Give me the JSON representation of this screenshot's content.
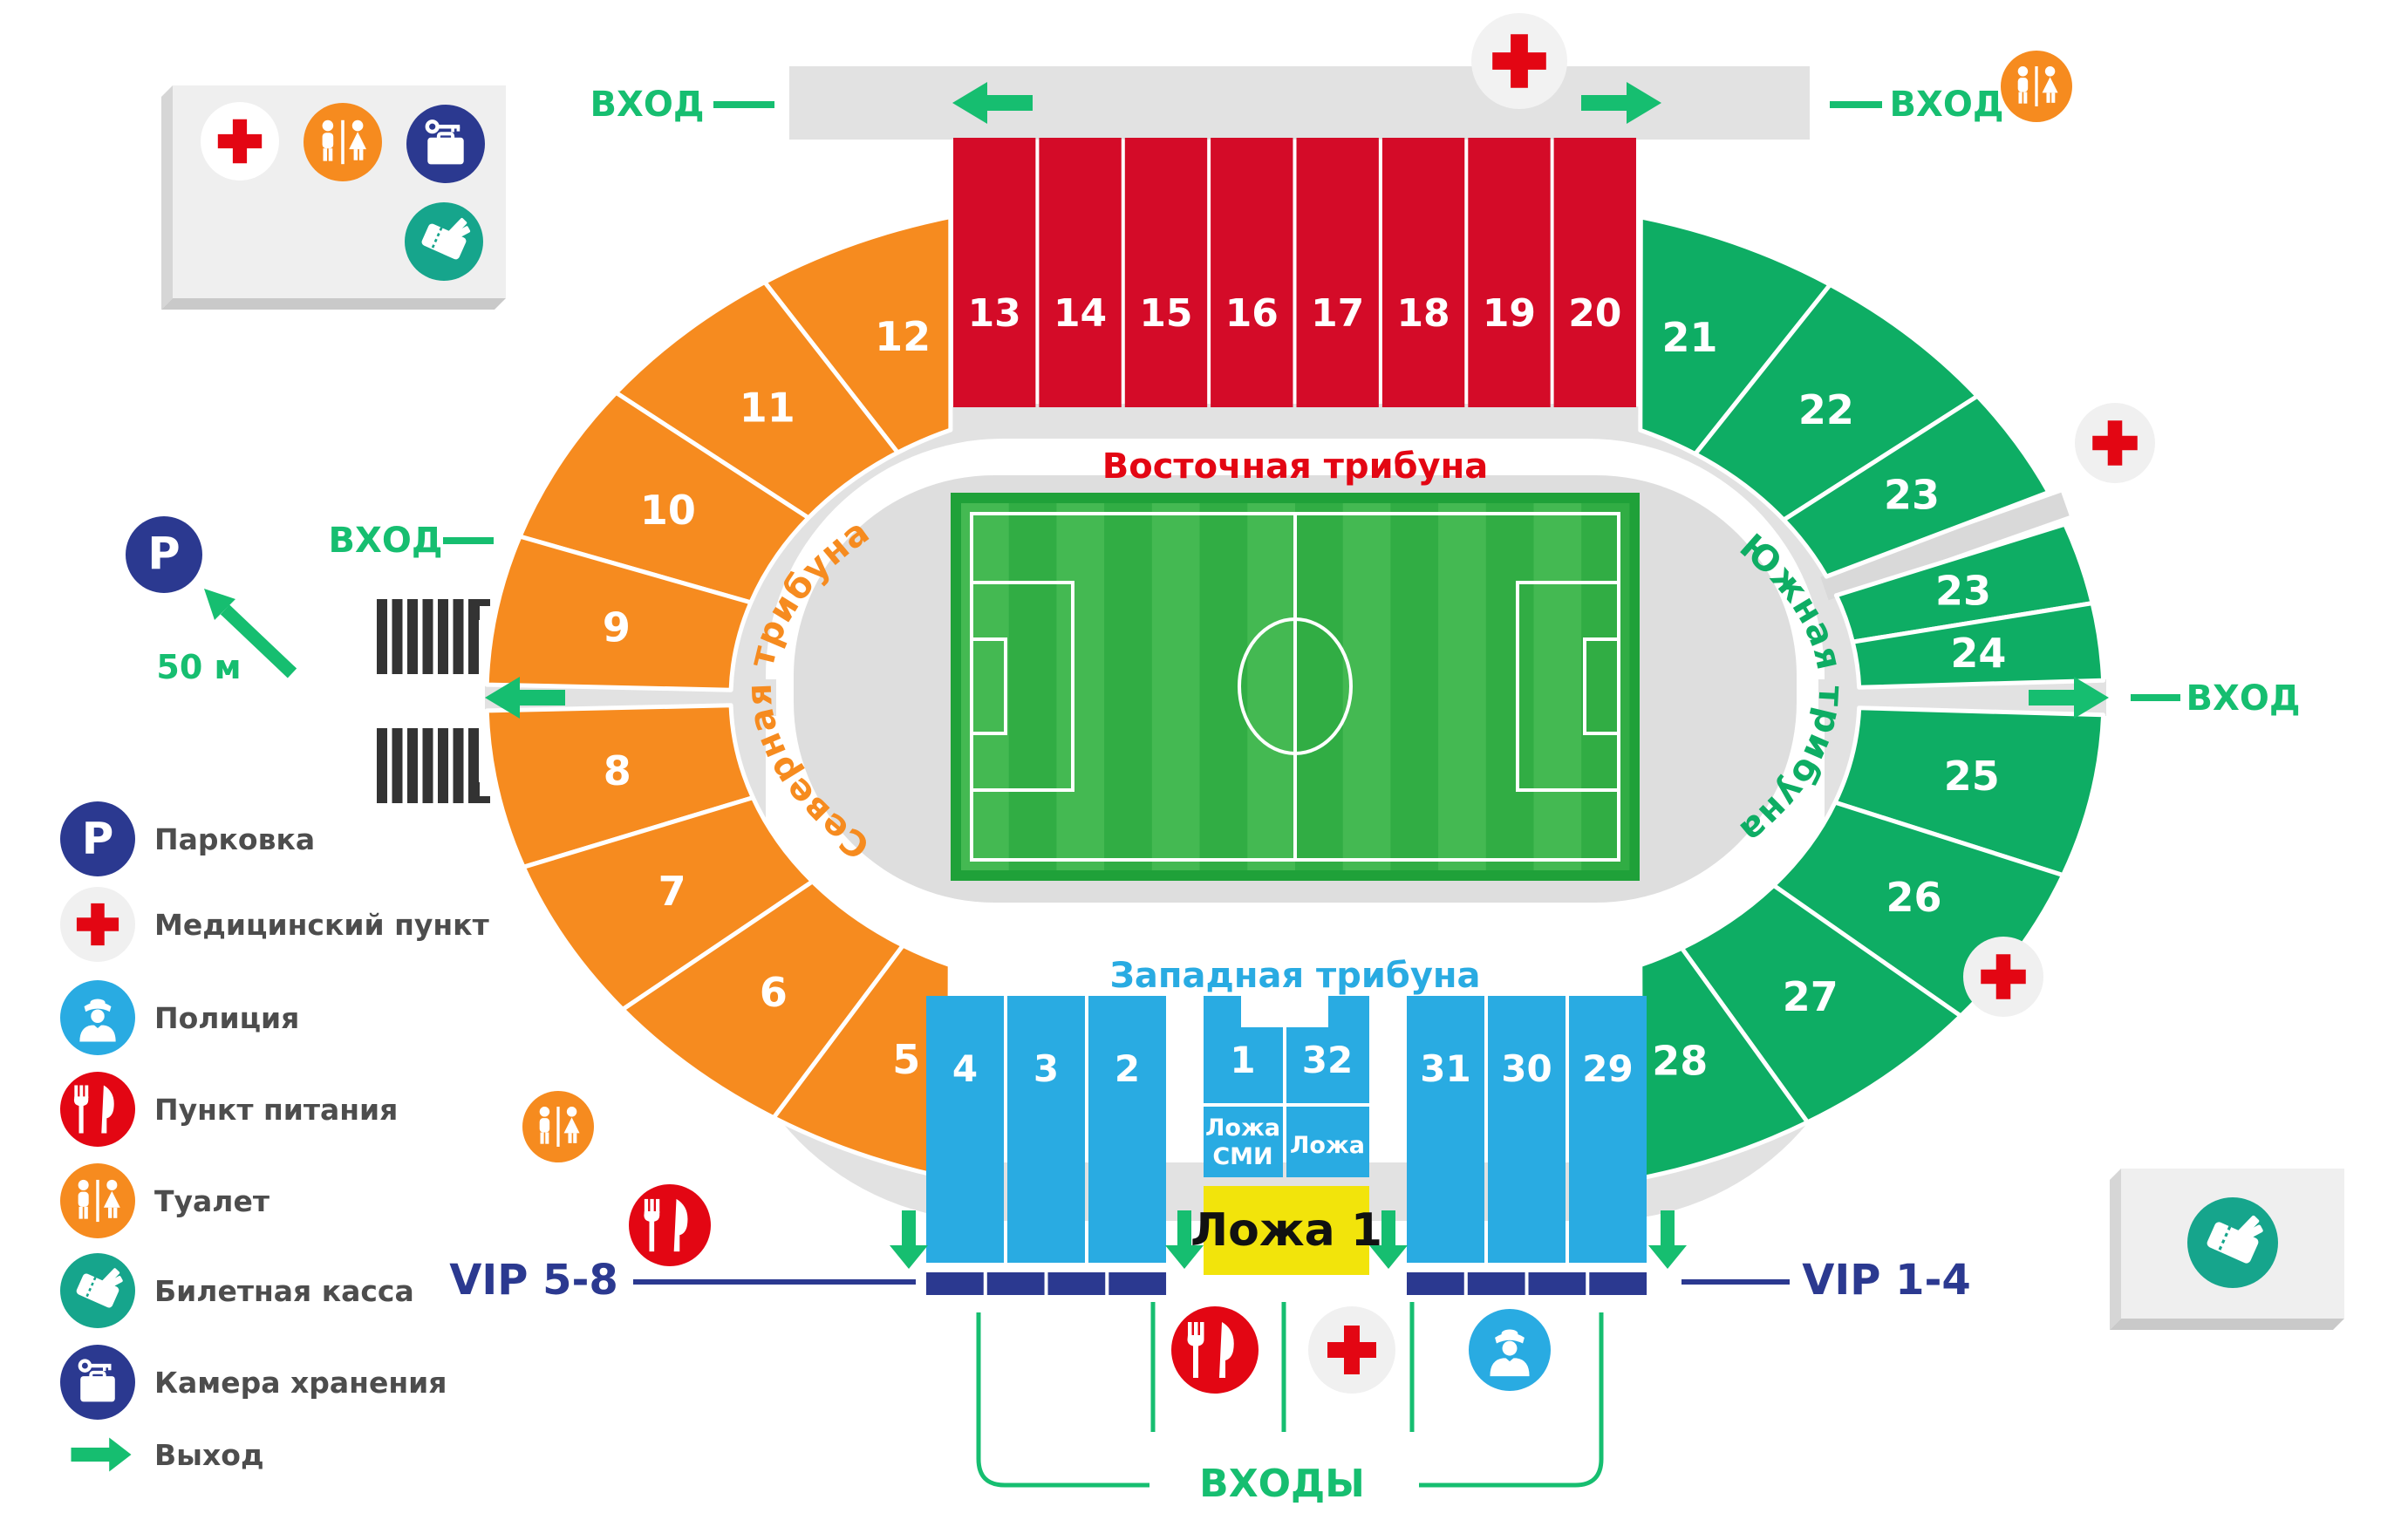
{
  "entrances": {
    "top_left": "ВХОД",
    "top_right": "ВХОД",
    "mid_left": "ВХОД",
    "mid_right": "ВХОД",
    "bottom_label": "ВХОДЫ"
  },
  "parking_distance": "50 м",
  "stands": {
    "north": "Северная трибуна",
    "east": "Восточная трибуна",
    "south": "Южная трибуна",
    "west": "Западная трибуна"
  },
  "sections": {
    "red": [
      "13",
      "14",
      "15",
      "16",
      "17",
      "18",
      "19",
      "20"
    ],
    "orange": [
      "12",
      "11",
      "10",
      "9",
      "8",
      "7",
      "6",
      "5"
    ],
    "green": [
      "21",
      "22",
      "23",
      "23",
      "24",
      "25",
      "26",
      "27",
      "28"
    ],
    "blue_left": [
      "4",
      "3",
      "2"
    ],
    "blue_center": [
      "1",
      "32"
    ],
    "blue_right": [
      "31",
      "30",
      "29"
    ]
  },
  "lodges": {
    "media": "Ложа СМИ",
    "plain": "Ложа",
    "vip_lodge": "Ложа 1"
  },
  "vip": {
    "left": "VIP 5-8",
    "right": "VIP 1-4"
  },
  "legend": [
    {
      "icon": "parking-icon",
      "label": "Парковка"
    },
    {
      "icon": "medical-icon",
      "label": "Медицинский пункт"
    },
    {
      "icon": "police-icon",
      "label": "Полиция"
    },
    {
      "icon": "food-icon",
      "label": "Пункт питания"
    },
    {
      "icon": "toilet-icon",
      "label": "Туалет"
    },
    {
      "icon": "tickets-icon",
      "label": "Билетная касса"
    },
    {
      "icon": "storage-icon",
      "label": "Камера хранения"
    },
    {
      "icon": "exit-icon",
      "label": "Выход"
    }
  ],
  "colors": {
    "orange": "#F68B1F",
    "red": "#D40B28",
    "green_stand": "#0EAD64",
    "blue": "#29ABE2",
    "navy": "#2B3990",
    "yellow": "#F2E40B",
    "teal": "#16A58C",
    "accent_green": "#16BE70",
    "gray_band": "#E2E2E2",
    "gray_infield": "#DEDEDE",
    "legend_text": "#4D4D4D",
    "label_red": "#E30613",
    "label_blue": "#29ABE2",
    "field_dark": "#1FA139",
    "field_light": "#44B952",
    "field_mid": "#31AD44",
    "hatch_black": "#333333"
  }
}
